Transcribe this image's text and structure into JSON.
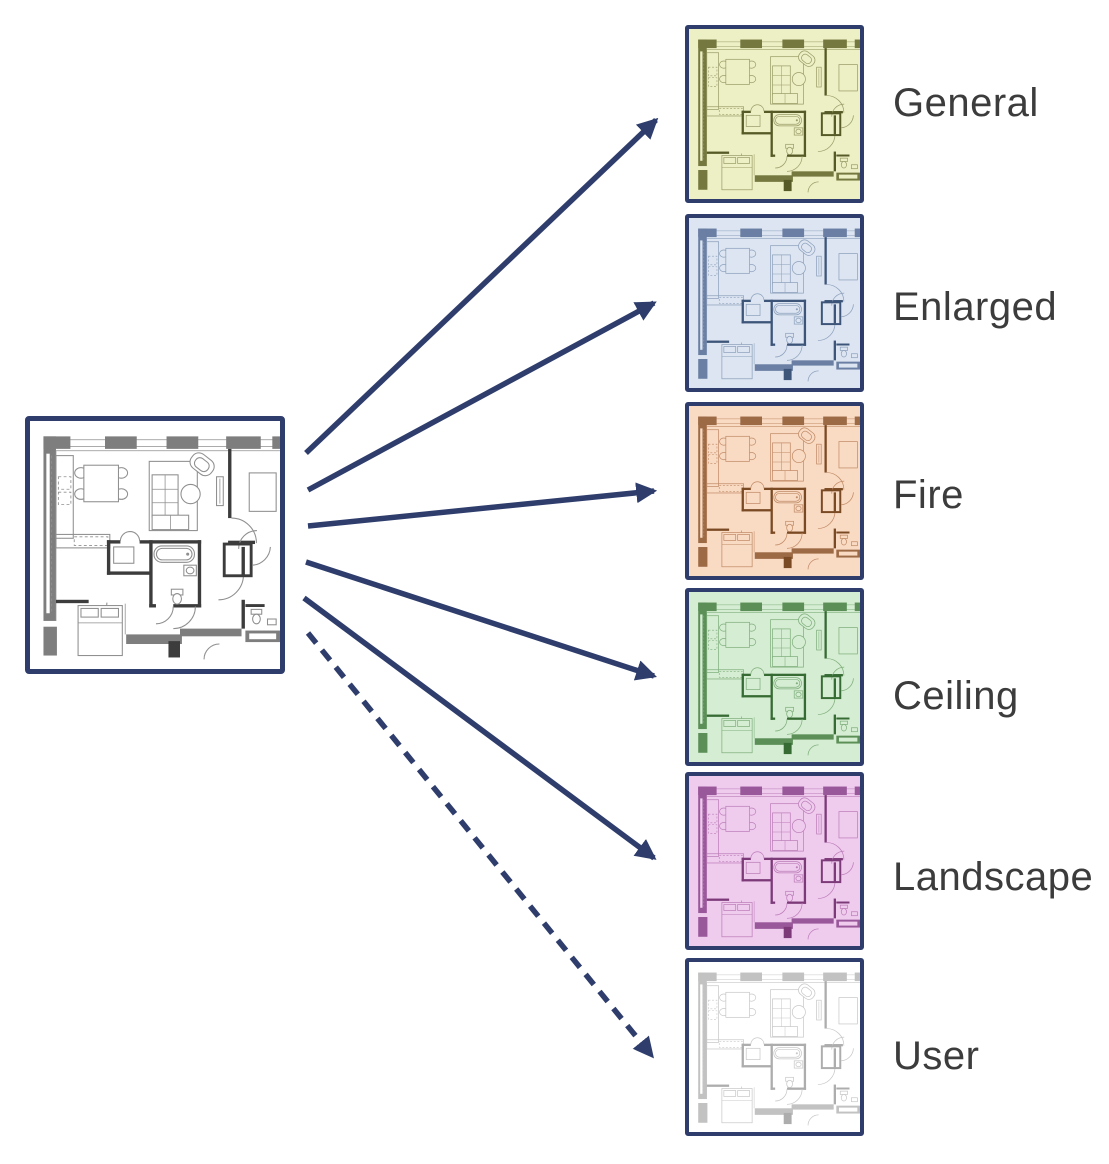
{
  "diagram": {
    "colors": {
      "navy": "#2E3D6C",
      "label_text": "#3C3C3C",
      "source_palette": {
        "bg": "#FFFFFF",
        "line": "#8F8F8F",
        "wall": "#7E7E7E",
        "dark": "#3C3C3C"
      }
    },
    "source": {
      "name": "floor-plan"
    },
    "variants": [
      {
        "label": "General",
        "arrow": "solid",
        "colors": {
          "bg": "#EDEFC5",
          "line": "#9A9D68",
          "wall": "#75793F",
          "dark": "#565A26"
        }
      },
      {
        "label": "Enlarged",
        "arrow": "solid",
        "colors": {
          "bg": "#DCE5F1",
          "line": "#8DA0BC",
          "wall": "#6B7FA4",
          "dark": "#3D5579"
        }
      },
      {
        "label": "Fire",
        "arrow": "solid",
        "colors": {
          "bg": "#F9DAC3",
          "line": "#C08B67",
          "wall": "#9C6A45",
          "dark": "#7A4A24"
        }
      },
      {
        "label": "Ceiling",
        "arrow": "solid",
        "colors": {
          "bg": "#D5EDD2",
          "line": "#7FAE7C",
          "wall": "#5C8F58",
          "dark": "#376B34"
        }
      },
      {
        "label": "Landscape",
        "arrow": "solid",
        "colors": {
          "bg": "#EFCBEE",
          "line": "#BC7EB8",
          "wall": "#99589A",
          "dark": "#7C3A78"
        }
      },
      {
        "label": "User",
        "arrow": "dashed",
        "colors": {
          "bg": "#FFFFFF",
          "line": "#C8C8C8",
          "wall": "#C2C2C2",
          "dark": "#ADADAD"
        }
      }
    ]
  }
}
